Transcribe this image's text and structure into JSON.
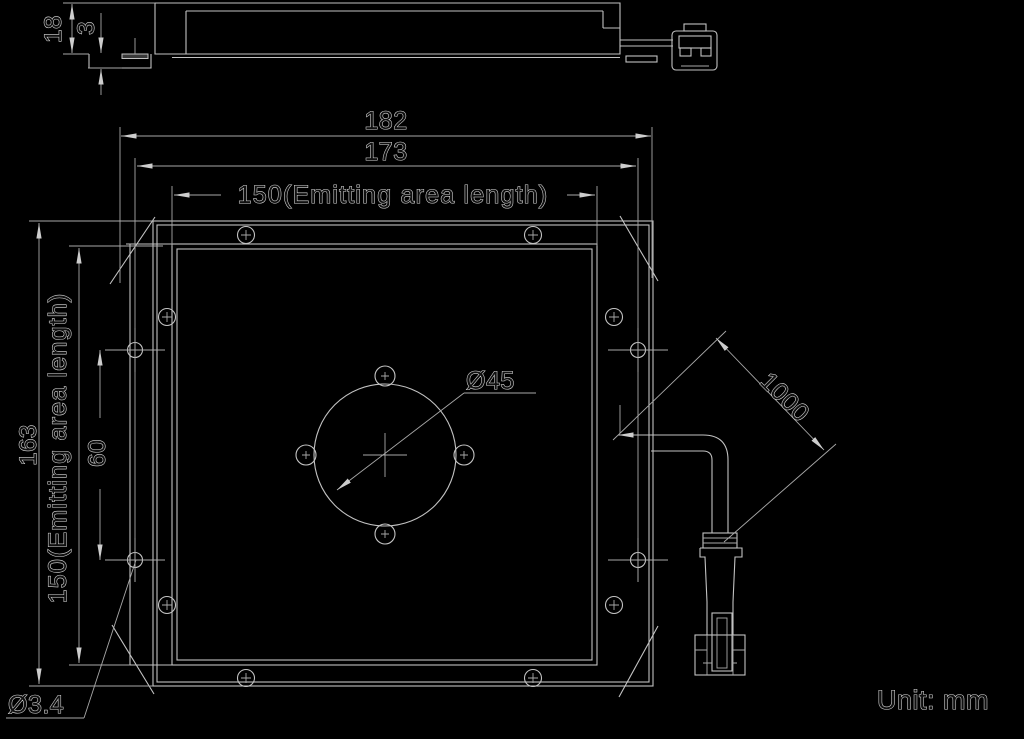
{
  "drawing": {
    "unit_note": "Unit: mm",
    "side_view": {
      "thickness": "18",
      "edge_step": "3"
    },
    "plan_view": {
      "overall_width": "182",
      "mounting_pitch_width": "173",
      "emitting_width": "150(Emitting area length)",
      "overall_height": "163",
      "emitting_height": "150(Emitting area length)",
      "left_hole_pitch": "60",
      "center_hole_diameter": "Ø45",
      "mounting_hole_diameter": "Ø3.4"
    },
    "cable": {
      "length": "1000"
    },
    "colors": {
      "background": "#000000",
      "line": "#c2c2c2",
      "text_outline": "#dadada"
    }
  }
}
